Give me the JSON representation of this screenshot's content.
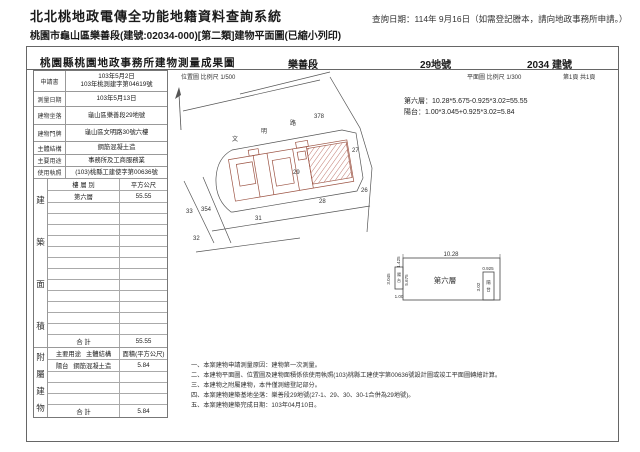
{
  "page": {
    "system_title": "北北桃地政電傳全功能地籍資料查詢系統",
    "query_date": "查詢日期：114年 9月16日（如需登記謄本，請向地政事務所申請。）",
    "subtitle": "桃園市龜山區樂善段(建號:02034-000)[第二類]建物平面圖(已縮小列印)"
  },
  "doc": {
    "office_title": "桃園縣桃園地政事務所建物測量成果圖",
    "section_name": "樂善段",
    "land_no": "29地號",
    "building_no": "2034 建號",
    "location_scale": "位置圖 比例尺  1/500",
    "plan_scale": "平面圖 比例尺  1/300",
    "page_no": "第1頁 共1頁",
    "info": {
      "rows": [
        {
          "label": "申請書",
          "value": "103年5月2日",
          "value2": "103年桃測建字第04619號"
        },
        {
          "label": "測量日期",
          "value": "103年5月13日"
        },
        {
          "label": "建物坐落",
          "value": "龜山區樂善段29地號"
        },
        {
          "label": "建物門牌",
          "value": "龜山區文明路30號六樓"
        },
        {
          "label": "主體結構",
          "value": "鋼筋混凝土造"
        },
        {
          "label": "主要用途",
          "value": "事務所及工商服務業"
        },
        {
          "label": "使用執照",
          "value": "(103)桃縣工建使字第00636號"
        }
      ]
    },
    "area_table": {
      "side_label": [
        "建",
        "築",
        "面",
        "積"
      ],
      "col1": "樓 層 別",
      "col2": "平方公尺",
      "floor": "第六層",
      "floor_area": "55.55",
      "total_label": "合  計",
      "total": "55.55"
    },
    "annex_table": {
      "side_label": [
        "附",
        "屬",
        "建",
        "物"
      ],
      "header_use": "主要用途",
      "header_struct": "主體結構",
      "header_area": "面積(平方公尺)",
      "row_use": "陽台",
      "row_struct": "鋼筋混凝土造",
      "row_area": "5.84",
      "total_label": "合  計",
      "total": "5.84"
    },
    "formulas": [
      "第六層：10.28*5.675-0.925*3.02=55.55",
      "陽台：1.00*3.045+0.925*3.02=5.84"
    ],
    "site_plan": {
      "parcels": {
        "p378": "378",
        "p27": "27",
        "p26": "26",
        "p28": "28",
        "p29": "29",
        "p31": "31",
        "p32": "32",
        "p33": "33",
        "p354": "354"
      },
      "road_chars": [
        "文",
        "明",
        "路"
      ]
    },
    "floor_plan": {
      "top": "10.28",
      "room": "第六層",
      "left_top": "1.425",
      "left_balcony_h": "3.045",
      "main_h": "5.675",
      "left_balcony_w": "1.00",
      "right_balcony_w": "0.925",
      "right_balcony_h": "3.02",
      "balcony_chars": [
        "陽",
        "台"
      ]
    },
    "notes": [
      "一、本案建物申請測量原因：建物第一次測量。",
      "二、本建物平面圖、位置圖及建物面積係依使用執照(103)桃縣工建使字第00636號設計圖或竣工平面圖轉繪計算。",
      "三、本建物之附屬建物，本件僅測繪登記部分。",
      "四、本案建物建築基地坐落：樂善段29地號(27-1、29、30、30-1合併為29地號)。",
      "五、本案建物建築完成日期：103年04月10日。"
    ]
  }
}
